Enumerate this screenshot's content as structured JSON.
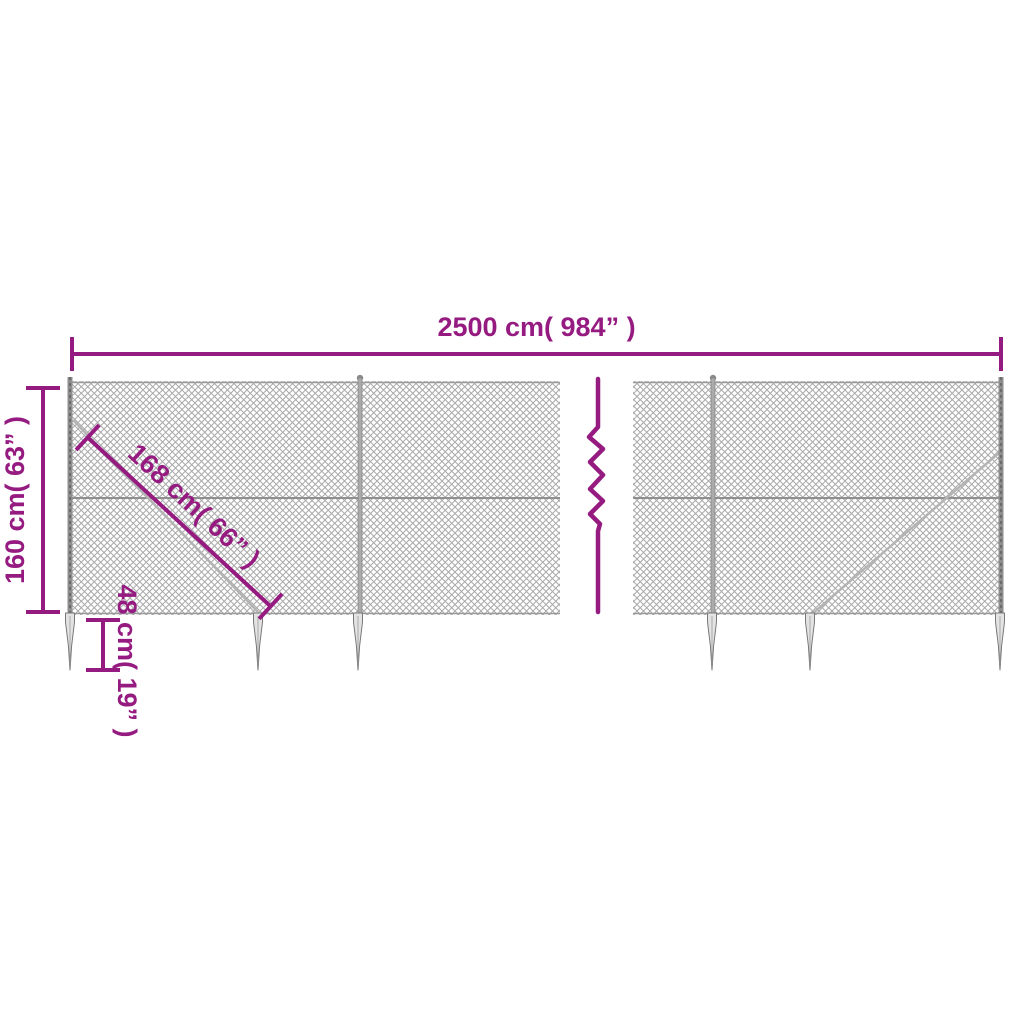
{
  "colors": {
    "accent": "#951b81",
    "mesh": "#a9a9a9",
    "metal": "#8e8e8e"
  },
  "diagram": {
    "type": "product-dimension-diagram",
    "subject": "chain-link fence with ground spike anchors",
    "dimensions": {
      "total_width": "2500 cm( 984” )",
      "fence_height": "160 cm( 63” )",
      "diagonal_brace": "168 cm( 66” )",
      "spike_depth": "48 cm( 19” )"
    }
  }
}
